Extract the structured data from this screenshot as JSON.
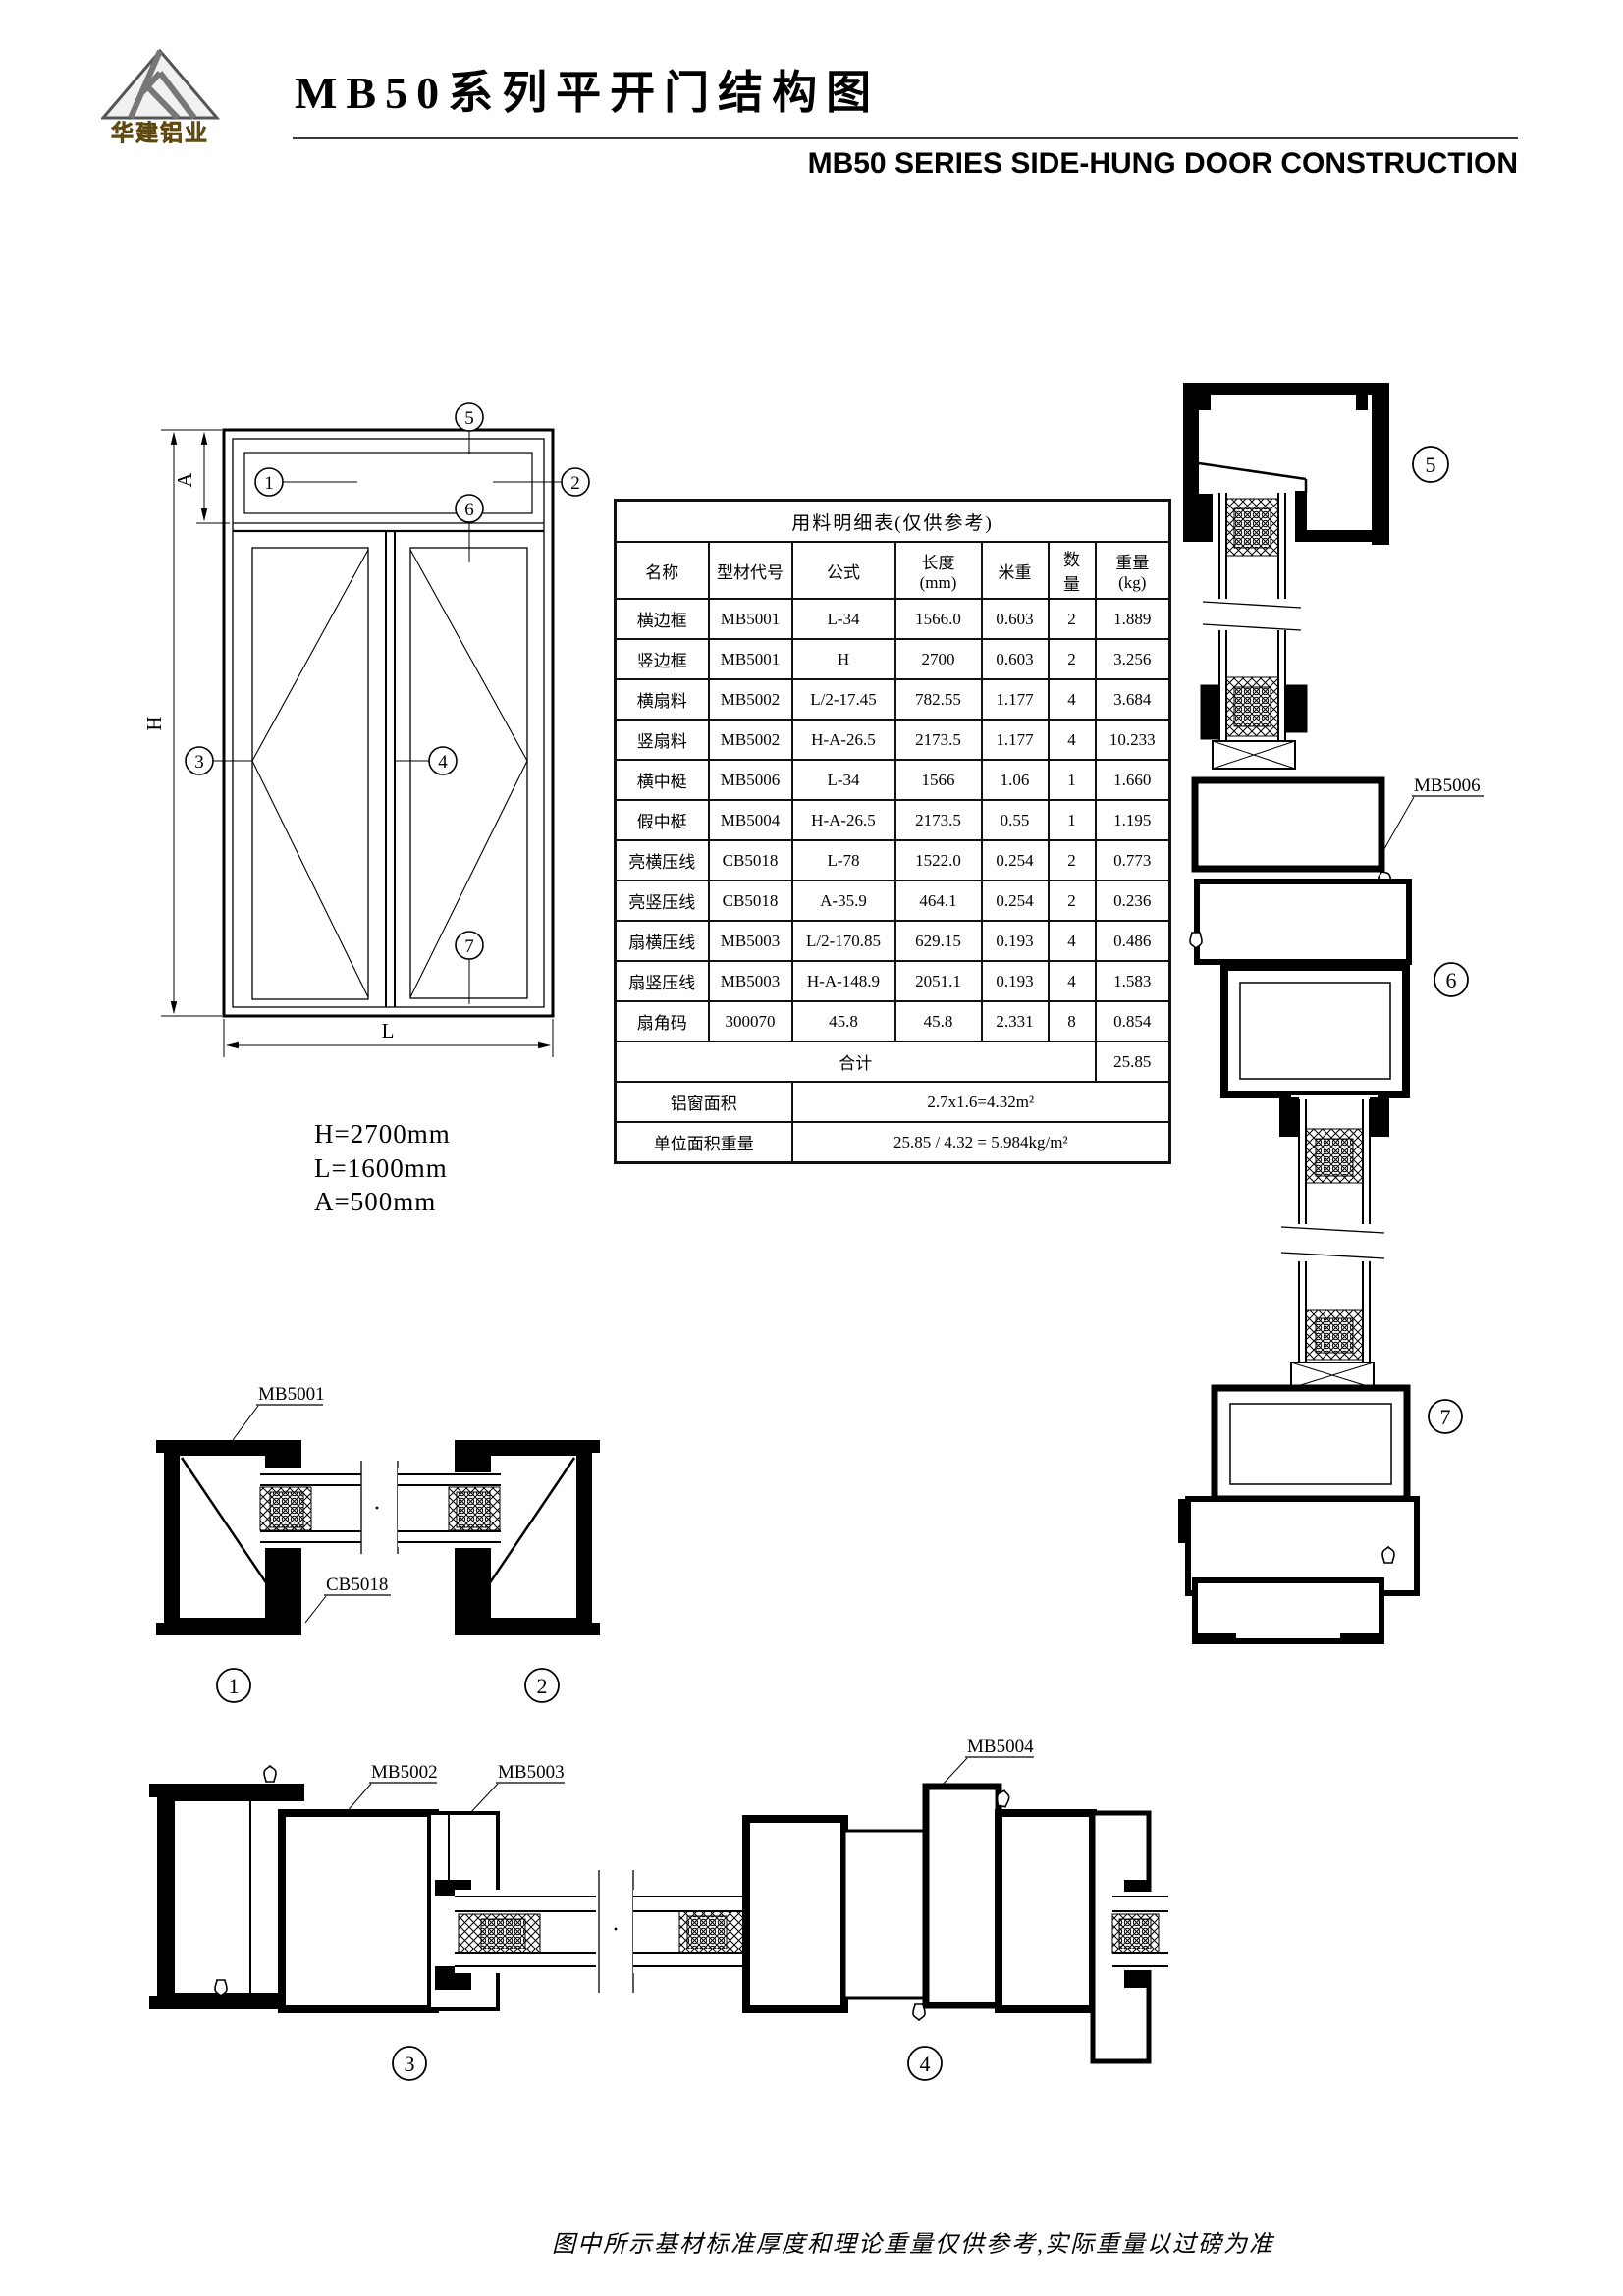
{
  "header": {
    "logo_text": "华建铝业",
    "title_cn": "MB50系列平开门结构图",
    "title_en": "MB50 SERIES SIDE-HUNG DOOR CONSTRUCTION"
  },
  "elevation": {
    "dim_h_axis": "H",
    "dim_a_axis": "A",
    "dim_l_axis": "L",
    "dim_h": "H=2700mm",
    "dim_l": "L=1600mm",
    "dim_a": "A=500mm"
  },
  "callouts": {
    "c1": "1",
    "c2": "2",
    "c3": "3",
    "c4": "4",
    "c5": "5",
    "c6": "6",
    "c7": "7"
  },
  "sections": {
    "mb5001": "MB5001",
    "cb5018": "CB5018",
    "mb5002": "MB5002",
    "mb5003": "MB5003",
    "mb5004": "MB5004",
    "mb5006": "MB5006"
  },
  "table": {
    "title": "用料明细表(仅供参考)",
    "h_name": "名称",
    "h_code": "型材代号",
    "h_formula": "公式",
    "h_len1": "长度",
    "h_len2": "(mm)",
    "h_mw": "米重",
    "h_qty1": "数",
    "h_qty2": "量",
    "h_wt1": "重量",
    "h_wt2": "(kg)",
    "rows": [
      {
        "name": "横边框",
        "code": "MB5001",
        "formula": "L-34",
        "length": "1566.0",
        "mw": "0.603",
        "qty": "2",
        "wt": "1.889"
      },
      {
        "name": "竖边框",
        "code": "MB5001",
        "formula": "H",
        "length": "2700",
        "mw": "0.603",
        "qty": "2",
        "wt": "3.256"
      },
      {
        "name": "横扇料",
        "code": "MB5002",
        "formula": "L/2-17.45",
        "length": "782.55",
        "mw": "1.177",
        "qty": "4",
        "wt": "3.684"
      },
      {
        "name": "竖扇料",
        "code": "MB5002",
        "formula": "H-A-26.5",
        "length": "2173.5",
        "mw": "1.177",
        "qty": "4",
        "wt": "10.233"
      },
      {
        "name": "横中梃",
        "code": "MB5006",
        "formula": "L-34",
        "length": "1566",
        "mw": "1.06",
        "qty": "1",
        "wt": "1.660"
      },
      {
        "name": "假中梃",
        "code": "MB5004",
        "formula": "H-A-26.5",
        "length": "2173.5",
        "mw": "0.55",
        "qty": "1",
        "wt": "1.195"
      },
      {
        "name": "亮横压线",
        "code": "CB5018",
        "formula": "L-78",
        "length": "1522.0",
        "mw": "0.254",
        "qty": "2",
        "wt": "0.773"
      },
      {
        "name": "亮竖压线",
        "code": "CB5018",
        "formula": "A-35.9",
        "length": "464.1",
        "mw": "0.254",
        "qty": "2",
        "wt": "0.236"
      },
      {
        "name": "扇横压线",
        "code": "MB5003",
        "formula": "L/2-170.85",
        "length": "629.15",
        "mw": "0.193",
        "qty": "4",
        "wt": "0.486"
      },
      {
        "name": "扇竖压线",
        "code": "MB5003",
        "formula": "H-A-148.9",
        "length": "2051.1",
        "mw": "0.193",
        "qty": "4",
        "wt": "1.583"
      },
      {
        "name": "扇角码",
        "code": "300070",
        "formula": "45.8",
        "length": "45.8",
        "mw": "2.331",
        "qty": "8",
        "wt": "0.854"
      }
    ],
    "total_label": "合计",
    "total_value": "25.85",
    "area_label": "铝窗面积",
    "area_value": "2.7x1.6=4.32m²",
    "unit_label": "单位面积重量",
    "unit_value": "25.85 / 4.32 = 5.984kg/m²"
  },
  "footer": {
    "note": "图中所示基材标准厚度和理论重量仅供参考,实际重量以过磅为准"
  }
}
